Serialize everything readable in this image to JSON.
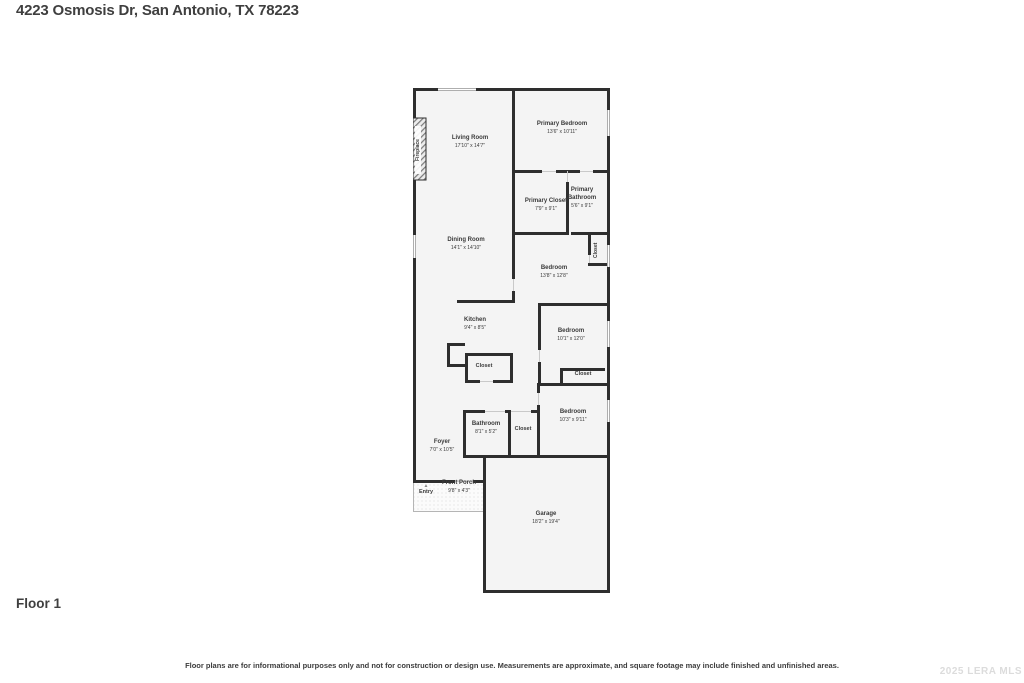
{
  "page": {
    "title": "4223 Osmosis Dr, San Antonio, TX 78223",
    "floor_label": "Floor 1",
    "disclaimer": "Floor plans are for informational purposes only and not for construction or design use. Measurements are approximate, and square footage may include finished and unfinished areas.",
    "watermark": "2025 LERA MLS"
  },
  "icons": {
    "entry_arrow": "▲"
  },
  "labels": {
    "fireplace": "Fireplace",
    "closet": "Closet",
    "entry": "Entry"
  },
  "rooms": {
    "living_room": {
      "name": "Living Room",
      "dims": "17'10\" x 14'7\""
    },
    "primary_bedroom": {
      "name": "Primary Bedroom",
      "dims": "13'6\" x 10'11\""
    },
    "primary_closet": {
      "name": "Primary Closet",
      "dims": "7'9\" x 9'1\""
    },
    "primary_bathroom": {
      "name": "Primary Bathroom",
      "dims": "5'6\" x 9'1\""
    },
    "dining_room": {
      "name": "Dining Room",
      "dims": "14'1\" x 14'10\""
    },
    "bedroom_2": {
      "name": "Bedroom",
      "dims": "13'8\" x 12'8\""
    },
    "kitchen": {
      "name": "Kitchen",
      "dims": "9'4\" x 8'5\""
    },
    "bedroom_3": {
      "name": "Bedroom",
      "dims": "10'1\" x 12'0\""
    },
    "bathroom": {
      "name": "Bathroom",
      "dims": "8'1\" x 5'2\""
    },
    "bedroom_4": {
      "name": "Bedroom",
      "dims": "10'3\" x 9'11\""
    },
    "foyer": {
      "name": "Foyer",
      "dims": "7'0\" x 10'5\""
    },
    "front_porch": {
      "name": "Front Porch",
      "dims": "9'8\" x 4'3\""
    },
    "garage": {
      "name": "Garage",
      "dims": "18'2\" x 19'4\""
    }
  }
}
